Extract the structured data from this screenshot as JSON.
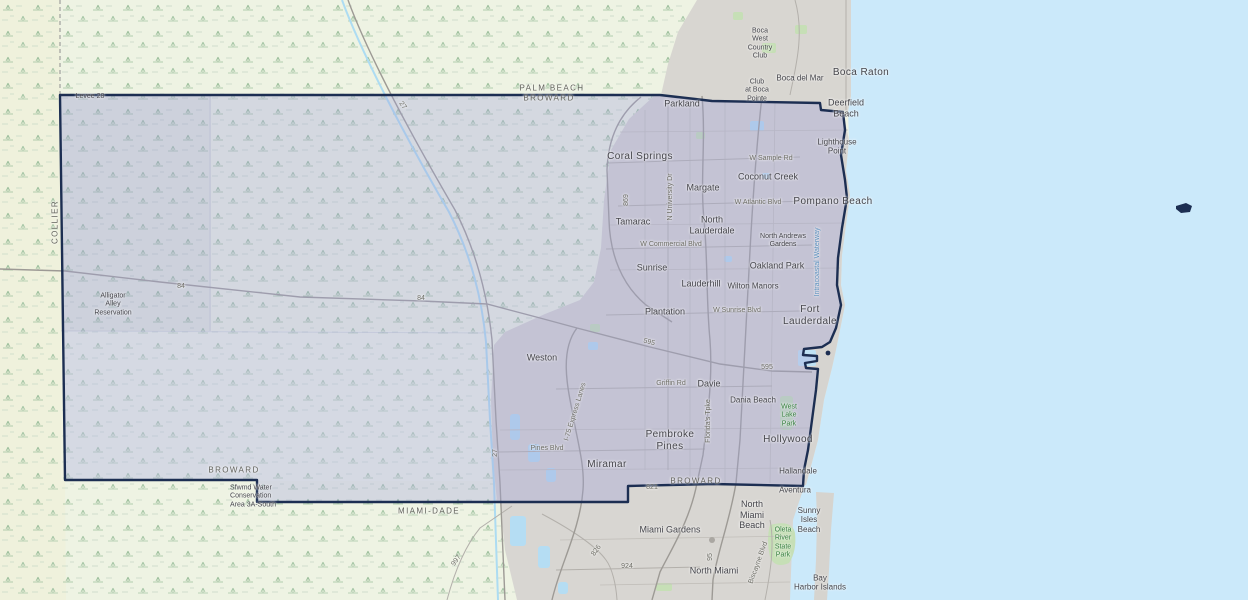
{
  "map": {
    "kind": "county-highlight-basemap",
    "highlighted_county": "BROWARD",
    "colors": {
      "ocean": "#cbe9fa",
      "county_fill": "#a0a4dc",
      "county_border": "#1c2e52",
      "urban": "#d7d5d0",
      "everglades": "#eef3e3",
      "swamp_symbol": "#9cbf9c",
      "park_green": "#c6dfb6",
      "lake_blue": "#b5ddf3"
    }
  },
  "labels": {
    "places": [
      "Boca Raton",
      "Boca del Mar",
      "Boca\nWest\nCountry\nClub",
      "Club\nat Boca\nPointe",
      "Deerfield\nBeach",
      "Parkland",
      "Coral Springs",
      "Margate",
      "Coconut Creek",
      "Lighthouse\nPoint",
      "Pompano Beach",
      "Tamarac",
      "North\nLauderdale",
      "North Andrews\nGardens",
      "Oakland Park",
      "Sunrise",
      "Lauderhill",
      "Wilton Manors",
      "Plantation",
      "Fort\nLauderdale",
      "Weston",
      "Davie",
      "Dania Beach",
      "Pembroke\nPines",
      "Hollywood",
      "Miramar",
      "Hallandale",
      "Aventura",
      "North\nMiami\nBeach",
      "Sunny\nIsles\nBeach",
      "Miami Gardens",
      "North Miami",
      "Bay\nHarbor Islands",
      "Alligator\nAlley\nReservation",
      "Sfwmd Water\nConservation\nArea 3A-South",
      "Levee 28"
    ],
    "counties": [
      "PALM BEACH",
      "BROWARD",
      "COLLIER",
      "BROWARD",
      "BROWARD",
      "MIAMI-DADE"
    ],
    "roads": [
      "27",
      "84",
      "84",
      "869",
      "N University Dr",
      "W Sample Rd",
      "W Atlantic Blvd",
      "W Commercial Blvd",
      "W Sunrise Blvd",
      "595",
      "595",
      "Griffin Rd",
      "Florida's Tpke",
      "I-75 Express Lanes",
      "Pines Blvd",
      "27",
      "821",
      "826",
      "924",
      "997",
      "95",
      "Biscayne Blvd"
    ],
    "water": [
      "Intracoastal Waterway"
    ],
    "parks": [
      "West\nLake\nPark",
      "Oleta\nRiver\nState\nPark"
    ]
  }
}
